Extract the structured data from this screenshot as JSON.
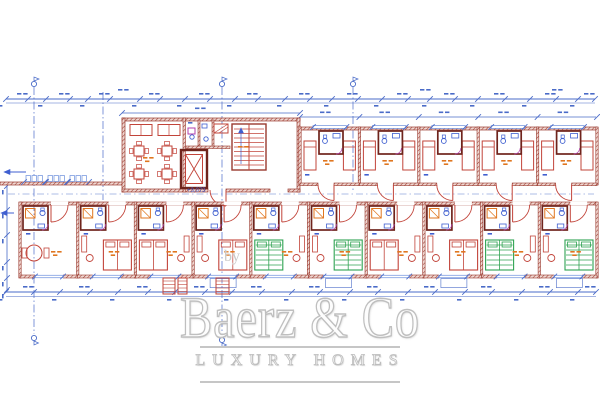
{
  "watermark": {
    "by": "by",
    "brand": "Baerz & Co",
    "tagline": "LUXURY HOMES"
  },
  "annotations": {
    "level_label": "+3,073"
  },
  "palette": {
    "wall": "#9a3a2f",
    "wall_dark": "#6f241c",
    "wall_fill": "#f0d8d2",
    "furniture": "#c2443a",
    "dimension": "#4a6bc8",
    "fixture": "#3f5fd0",
    "window": "#7d9ce0",
    "label": "#e0761f",
    "green": "#2fa352",
    "magenta": "#b03fae",
    "watermark": "#c2c2c2"
  },
  "plan": {
    "canvas": {
      "w": 600,
      "h": 400
    },
    "top_dim": {
      "y": 99,
      "x1": 6,
      "x2": 595,
      "ticks": [
        6,
        28,
        46,
        70,
        88,
        110,
        140,
        160,
        185,
        210,
        235,
        258,
        285,
        310,
        332,
        358,
        382,
        408,
        430,
        455,
        478,
        505,
        530,
        556,
        578,
        595
      ]
    },
    "rooms_dim": {
      "y": 117,
      "x1": 300,
      "x2": 596
    },
    "central_dim": {
      "y": 113,
      "x1": 122,
      "x2": 300
    },
    "bottom_dim": {
      "y": 292,
      "x1": 6,
      "x2": 596,
      "ticks": [
        6,
        34,
        60,
        90,
        118,
        148,
        175,
        205,
        232,
        262,
        292,
        320,
        350,
        378,
        408,
        435,
        465,
        492,
        522,
        550,
        578,
        596
      ]
    },
    "left_dim": {
      "x": 7,
      "y1": 186,
      "y2": 290,
      "ticks": [
        186,
        210,
        235,
        262,
        278,
        290
      ]
    },
    "ref_lines": [
      {
        "x": 34,
        "y1": 87,
        "y2": 334,
        "top_flag": true,
        "bottom_flag": true
      },
      {
        "x": 103,
        "y1": 92,
        "y2": 200,
        "top_flag": false,
        "bottom_flag": false
      },
      {
        "x": 222,
        "y1": 87,
        "y2": 336,
        "top_flag": true,
        "bottom_flag": true
      },
      {
        "x": 353,
        "y1": 87,
        "y2": 190,
        "top_flag": true,
        "bottom_flag": false
      }
    ],
    "corridor_dash": {
      "y": 194,
      "x1": 8,
      "x2": 594
    },
    "top_rooms": {
      "x0": 300,
      "x1": 597,
      "y0": 127,
      "y1": 185,
      "count": 5
    },
    "bottom_rooms": {
      "x0": 20,
      "x1": 597,
      "y0": 202,
      "y1": 278,
      "count": 10,
      "green": [
        4,
        5,
        8,
        9
      ],
      "porch": [
        3,
        5,
        7,
        9
      ]
    },
    "central": {
      "x0": 122,
      "x1": 300,
      "y0": 118,
      "y1": 192
    },
    "left_wing": {
      "x0": 0,
      "x1": 123,
      "wall_y": 182,
      "windows": [
        26,
        48,
        70
      ],
      "arrows": [
        {
          "x": 4,
          "y": 172,
          "len": 22
        },
        {
          "x": 1,
          "y": 213,
          "len": 13
        }
      ]
    },
    "steps": [
      {
        "x": 163,
        "y": 278,
        "w": 12,
        "h": 16
      },
      {
        "x": 178,
        "y": 278,
        "w": 9,
        "h": 16
      },
      {
        "x": 216,
        "y": 278,
        "w": 13,
        "h": 16
      }
    ]
  }
}
